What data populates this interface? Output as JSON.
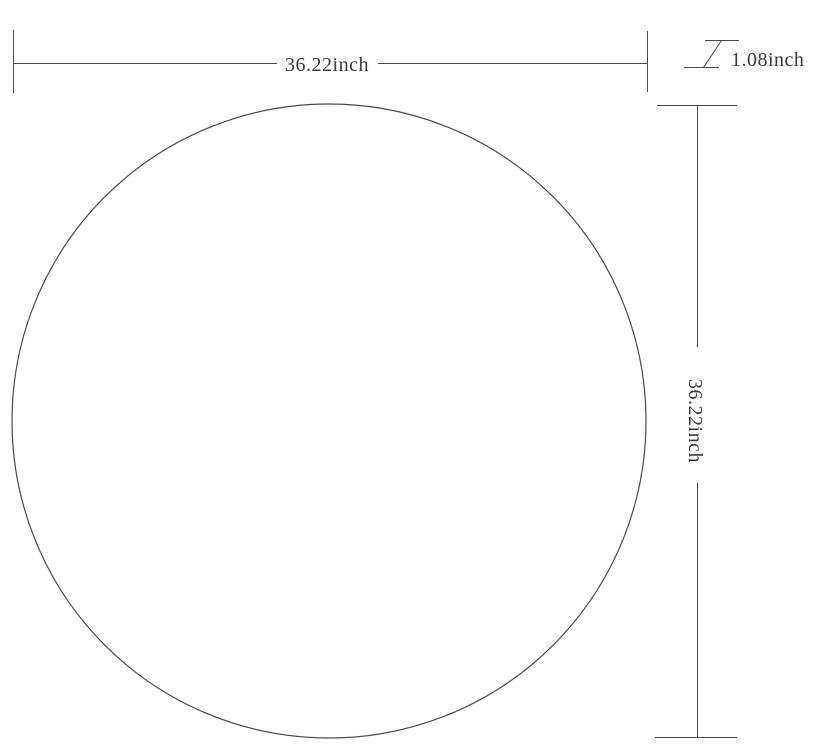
{
  "diagram": {
    "kind": "product-dimension-drawing",
    "shape": "circle",
    "dimensions": {
      "width": {
        "value": 36.22,
        "unit": "inch",
        "label": "36.22inch"
      },
      "height": {
        "value": 36.22,
        "unit": "inch",
        "label": "36.22inch"
      },
      "thickness": {
        "value": 1.08,
        "unit": "inch",
        "label": "1.08inch"
      }
    }
  },
  "colors": {
    "line": "#4a4a4a",
    "text": "#3b3b3b",
    "background": "#ffffff"
  }
}
